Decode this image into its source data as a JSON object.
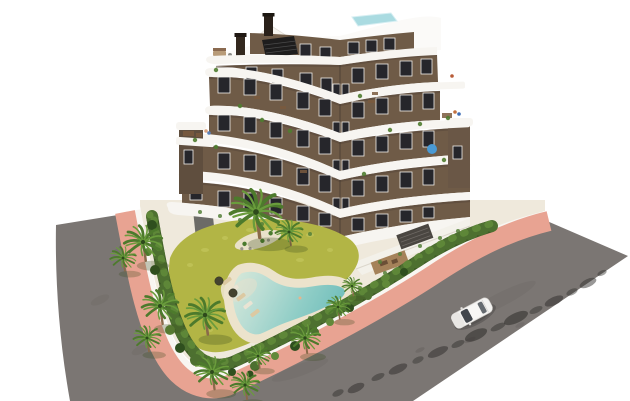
{
  "meta": {
    "title": "Aerial render of apartment residence with pool garden"
  },
  "scene": {
    "background": "#ffffff",
    "description": "Aerial 3D architectural render: modern 6-storey apartment building with curved white balcony bands and brown facade, landscaped garden with free-form lagoon pool, palm trees and hedges, salmon-pink sidewalks, two asphalt roads and one white car."
  },
  "colors": {
    "road_asphalt": "#7b7673",
    "sidewalk": "#e8a392",
    "curb": "#f8f6f2",
    "plot_paving": "#efe9dc",
    "lawn": "#b2b545",
    "lawn_light": "#c9cb63",
    "hedge": "#3e5a26",
    "hedge_mid": "#4d7030",
    "hedge_light": "#61893a",
    "palm_trunk": "#8a6a4a",
    "palm_frond": "#4d7a2c",
    "palm_frond_light": "#6a9c3c",
    "pool_sand": "#ece3cc",
    "pool_water_shallow": "#dcead9",
    "pool_water": "#8fcdc6",
    "pool_water_deep": "#72bfbc",
    "facade": "#6f5b47",
    "facade_dark": "#57473a",
    "band_white": "#f7f5f1",
    "roof_white": "#fbfaf8",
    "window": "#26262b",
    "window_frame": "#f2f0ec",
    "rooftop_pool": "#aadbe1",
    "pergola_dark": "#1e1d1d",
    "wood": "#a5825a",
    "car_body": "#f4f3f1",
    "car_glass": "#42464c"
  },
  "building": {
    "wings": 2,
    "floors": 6,
    "balcony_bands": 5,
    "rooftop_pool": true,
    "chimneys": 2,
    "windows": {
      "left": [
        [
          246,
          67,
          11,
          13
        ],
        [
          272,
          69,
          11,
          14
        ],
        [
          300,
          73,
          12,
          15
        ],
        [
          321,
          78,
          11,
          15
        ],
        [
          218,
          77,
          12,
          16
        ],
        [
          244,
          79,
          12,
          16
        ],
        [
          270,
          84,
          12,
          16
        ],
        [
          297,
          92,
          12,
          17
        ],
        [
          319,
          99,
          12,
          17
        ],
        [
          218,
          115,
          12,
          16
        ],
        [
          244,
          117,
          12,
          16
        ],
        [
          270,
          122,
          12,
          16
        ],
        [
          297,
          130,
          12,
          17
        ],
        [
          319,
          137,
          12,
          17
        ],
        [
          190,
          146,
          12,
          16
        ],
        [
          218,
          153,
          12,
          16
        ],
        [
          244,
          155,
          12,
          16
        ],
        [
          270,
          160,
          12,
          16
        ],
        [
          297,
          168,
          12,
          17
        ],
        [
          319,
          175,
          12,
          17
        ],
        [
          190,
          184,
          12,
          16
        ],
        [
          218,
          191,
          12,
          16
        ],
        [
          244,
          193,
          12,
          16
        ],
        [
          270,
          198,
          12,
          16
        ],
        [
          297,
          206,
          12,
          15
        ],
        [
          319,
          213,
          12,
          13
        ]
      ],
      "right": [
        [
          352,
          68,
          12,
          15
        ],
        [
          376,
          64,
          12,
          15
        ],
        [
          400,
          61,
          12,
          15
        ],
        [
          421,
          59,
          11,
          15
        ],
        [
          352,
          102,
          12,
          16
        ],
        [
          376,
          98,
          12,
          16
        ],
        [
          400,
          95,
          12,
          16
        ],
        [
          423,
          93,
          11,
          16
        ],
        [
          352,
          140,
          12,
          16
        ],
        [
          376,
          136,
          12,
          16
        ],
        [
          400,
          133,
          12,
          16
        ],
        [
          423,
          131,
          11,
          16
        ],
        [
          352,
          180,
          12,
          16
        ],
        [
          376,
          176,
          12,
          16
        ],
        [
          400,
          172,
          12,
          16
        ],
        [
          423,
          169,
          11,
          16
        ],
        [
          352,
          218,
          12,
          13
        ],
        [
          376,
          214,
          12,
          13
        ],
        [
          400,
          210,
          12,
          12
        ],
        [
          423,
          207,
          11,
          11
        ]
      ],
      "attic": [
        [
          300,
          44,
          11,
          12
        ],
        [
          320,
          47,
          11,
          12
        ],
        [
          348,
          42,
          11,
          12
        ],
        [
          366,
          40,
          11,
          12
        ],
        [
          384,
          38,
          11,
          12
        ]
      ],
      "corner": [
        [
          333,
          84,
          7,
          17
        ],
        [
          333,
          122,
          7,
          17
        ],
        [
          333,
          160,
          7,
          17
        ],
        [
          333,
          198,
          7,
          17
        ],
        [
          342,
          84,
          7,
          17
        ],
        [
          342,
          122,
          7,
          17
        ],
        [
          342,
          160,
          7,
          17
        ],
        [
          342,
          198,
          7,
          17
        ]
      ]
    },
    "balcony_plants": [
      [
        216,
        70
      ],
      [
        240,
        106
      ],
      [
        262,
        120
      ],
      [
        290,
        131
      ],
      [
        216,
        147
      ],
      [
        360,
        96
      ],
      [
        390,
        130
      ],
      [
        420,
        124
      ],
      [
        364,
        174
      ],
      [
        444,
        160
      ],
      [
        195,
        140
      ],
      [
        448,
        118
      ]
    ],
    "furniture": [
      [
        254,
        96,
        6,
        3
      ],
      [
        280,
        106,
        6,
        3
      ],
      [
        368,
        100,
        7,
        3
      ],
      [
        300,
        170,
        7,
        3
      ],
      [
        183,
        131,
        11,
        5
      ],
      [
        196,
        133,
        6,
        4
      ],
      [
        442,
        113,
        10,
        5
      ],
      [
        372,
        92,
        6,
        3
      ]
    ],
    "people": [
      [
        206,
        131,
        "#d9a27e"
      ],
      [
        209,
        133,
        "#5a80b8"
      ],
      [
        455,
        112,
        "#c2713f"
      ],
      [
        459,
        114,
        "#3d6db5"
      ],
      [
        452,
        76,
        "#b85c38"
      ]
    ]
  },
  "site": {
    "lawn": true,
    "hedge": true,
    "pool": {
      "shape": "freeform lagoon",
      "beach_entry": true,
      "loungers": 7,
      "parasols": 2
    },
    "palms": [
      [
        143,
        242,
        1.25
      ],
      [
        123,
        258,
        0.85
      ],
      [
        160,
        306,
        1.2
      ],
      [
        147,
        338,
        0.9
      ],
      [
        205,
        315,
        1.3
      ],
      [
        212,
        372,
        1.15
      ],
      [
        245,
        385,
        0.95
      ],
      [
        258,
        356,
        0.8
      ],
      [
        305,
        338,
        1.0
      ],
      [
        338,
        307,
        0.8
      ],
      [
        289,
        232,
        0.9
      ],
      [
        352,
        286,
        0.65
      ],
      [
        256,
        212,
        1.7
      ]
    ],
    "bushes": [
      [
        152,
        225,
        5
      ],
      [
        158,
        237,
        4
      ],
      [
        148,
        252,
        4
      ],
      [
        155,
        270,
        5
      ],
      [
        162,
        290,
        4
      ],
      [
        170,
        330,
        5
      ],
      [
        180,
        348,
        5
      ],
      [
        196,
        360,
        6
      ],
      [
        215,
        370,
        5
      ],
      [
        232,
        372,
        4
      ],
      [
        255,
        366,
        5
      ],
      [
        275,
        356,
        4
      ],
      [
        295,
        346,
        5
      ],
      [
        315,
        332,
        4
      ],
      [
        330,
        322,
        4
      ],
      [
        350,
        308,
        4
      ],
      [
        368,
        296,
        4
      ],
      [
        386,
        284,
        4
      ],
      [
        404,
        272,
        4
      ],
      [
        420,
        262,
        4
      ],
      [
        150,
        215,
        3.5
      ],
      [
        250,
        374,
        3.5
      ]
    ],
    "loungers": [
      [
        227,
        281,
        -38,
        0
      ],
      [
        234,
        289,
        -38,
        1
      ],
      [
        241,
        297,
        -38,
        0
      ],
      [
        248,
        305,
        -38,
        1
      ],
      [
        255,
        313,
        -38,
        0
      ],
      [
        288,
        329,
        -15,
        1
      ],
      [
        296,
        331,
        -15,
        0
      ]
    ],
    "lawn_speckles": [
      [
        190,
        265,
        3,
        2
      ],
      [
        205,
        250,
        4,
        2
      ],
      [
        225,
        238,
        3,
        2
      ],
      [
        250,
        230,
        4,
        2
      ],
      [
        280,
        228,
        3,
        2
      ],
      [
        310,
        235,
        4,
        2
      ],
      [
        330,
        250,
        3,
        2
      ],
      [
        300,
        260,
        4,
        2
      ],
      [
        260,
        300,
        3,
        2
      ],
      [
        235,
        315,
        4,
        2
      ],
      [
        210,
        330,
        3,
        2
      ],
      [
        285,
        310,
        4,
        2
      ]
    ],
    "green_dots": [
      [
        260,
        346
      ],
      [
        285,
        333
      ],
      [
        310,
        318
      ],
      [
        335,
        303
      ],
      [
        360,
        288
      ],
      [
        385,
        273
      ],
      [
        200,
        212
      ],
      [
        220,
        216
      ],
      [
        240,
        220
      ],
      [
        262,
        224
      ],
      [
        285,
        229
      ],
      [
        310,
        234
      ],
      [
        380,
        262
      ],
      [
        400,
        254
      ],
      [
        420,
        246
      ],
      [
        440,
        238
      ],
      [
        458,
        231
      ]
    ]
  },
  "roads": {
    "count": 2,
    "surface": "asphalt",
    "sidewalk_color_name": "salmon",
    "shadow_blobs": [
      [
        338,
        393,
        6,
        3,
        0.5
      ],
      [
        356,
        388,
        9,
        4,
        0.55
      ],
      [
        378,
        377,
        7,
        3,
        0.5
      ],
      [
        398,
        369,
        10,
        4,
        0.55
      ],
      [
        418,
        360,
        6,
        3,
        0.45
      ],
      [
        438,
        352,
        11,
        4,
        0.55
      ],
      [
        458,
        344,
        7,
        3,
        0.5
      ],
      [
        476,
        335,
        12,
        5,
        0.6
      ],
      [
        498,
        327,
        8,
        3,
        0.5
      ],
      [
        516,
        318,
        13,
        5,
        0.6
      ],
      [
        536,
        310,
        7,
        3,
        0.45
      ],
      [
        554,
        301,
        10,
        4,
        0.55
      ],
      [
        572,
        292,
        6,
        3,
        0.45
      ],
      [
        588,
        283,
        9,
        4,
        0.5
      ],
      [
        602,
        273,
        5,
        2.5,
        0.45
      ],
      [
        420,
        350,
        5,
        2,
        0.15
      ],
      [
        470,
        340,
        6,
        2,
        0.15
      ],
      [
        520,
        325,
        5,
        2,
        0.12
      ],
      [
        120,
        250,
        8,
        3,
        0.08
      ],
      [
        100,
        300,
        10,
        4,
        0.07
      ],
      [
        140,
        350,
        9,
        4,
        0.07
      ]
    ]
  },
  "vehicle": {
    "type": "car",
    "count": 1,
    "color": "white",
    "location": "right road",
    "heading": "southwest"
  }
}
